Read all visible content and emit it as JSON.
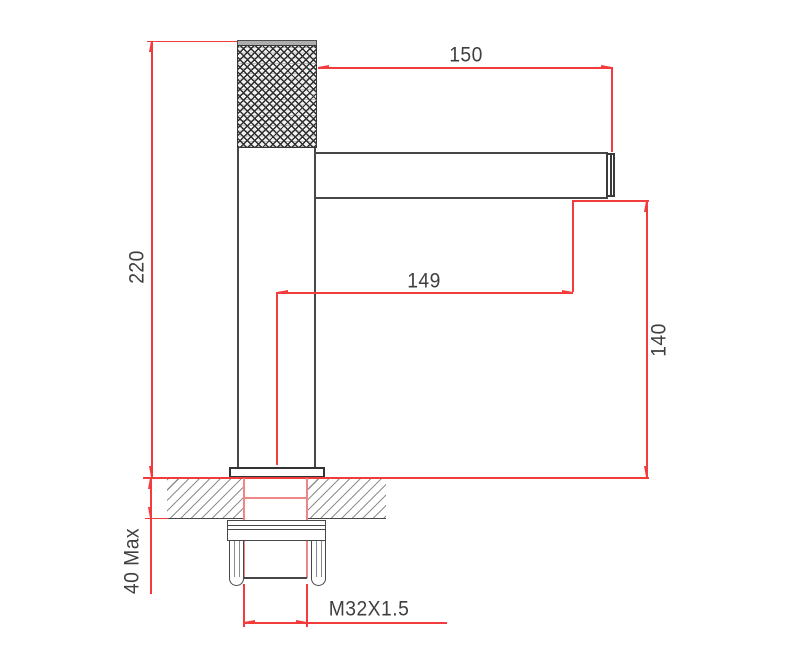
{
  "drawing": {
    "subject": "single-handle basin faucet with knurled grip - installation dimension drawing",
    "units_implied": "mm",
    "dimensions": {
      "overall_height": "220",
      "spout_length_top": "150",
      "spout_reach_center": "149",
      "spout_outlet_height": "140",
      "deck_thickness": "40 Max",
      "thread_spec": "M32X1.5"
    },
    "colors": {
      "dimension_red": "#f43b3b",
      "outline": "#474747",
      "outline_dark": "#333333",
      "hatch_gray": "#8f8f8f",
      "text": "#3f3f3f",
      "centerline_pink": "#ee8686"
    }
  }
}
